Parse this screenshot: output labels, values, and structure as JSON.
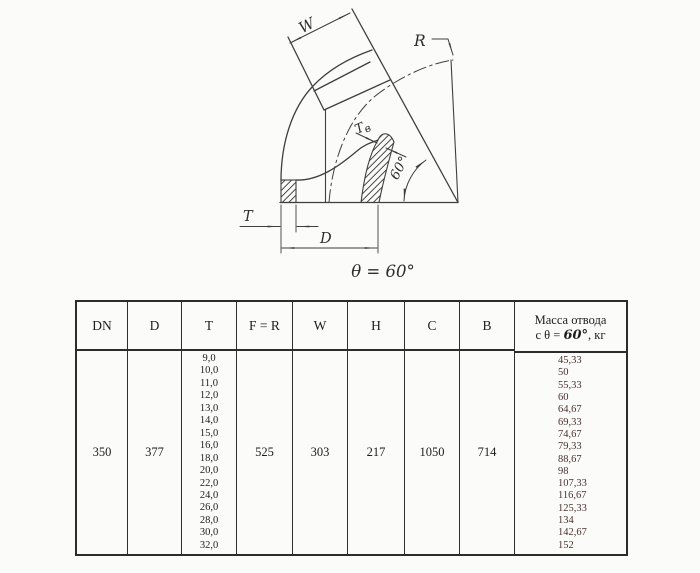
{
  "diagram": {
    "dim_w": "W",
    "dim_r": "R",
    "dim_t_inner_main": "Т",
    "dim_t_inner_sub": "в",
    "angle_label": "60°",
    "dim_t": "T",
    "dim_d": "D",
    "theta_caption": "θ = 60°"
  },
  "table": {
    "headers": {
      "dn": "DN",
      "d": "D",
      "t": "T",
      "fr": "F = R",
      "w": "W",
      "h": "H",
      "c": "C",
      "b": "B"
    },
    "mass_header": {
      "line1": "Масса отвода",
      "prefix": "с θ = ",
      "angle": "60°",
      "suffix": ", кг"
    },
    "values": {
      "dn": "350",
      "d": "377",
      "fr": "525",
      "w": "303",
      "h": "217",
      "c": "1050",
      "b": "714"
    },
    "t_values": [
      "9,0",
      "10,0",
      "11,0",
      "12,0",
      "13,0",
      "14,0",
      "15,0",
      "16,0",
      "18,0",
      "20,0",
      "22,0",
      "24,0",
      "26,0",
      "28,0",
      "30,0",
      "32,0"
    ],
    "mass_values": [
      "45,33",
      "50",
      "55,33",
      "60",
      "64,67",
      "69,33",
      "74,67",
      "79,33",
      "88,67",
      "98",
      "107,33",
      "116,67",
      "125,33",
      "134",
      "142,67",
      "152"
    ]
  },
  "colors": {
    "line": "#3f3f3f",
    "text": "#2e2e2e",
    "mass_value_text": "#4a3230",
    "table_border": "#2c2c2c"
  }
}
